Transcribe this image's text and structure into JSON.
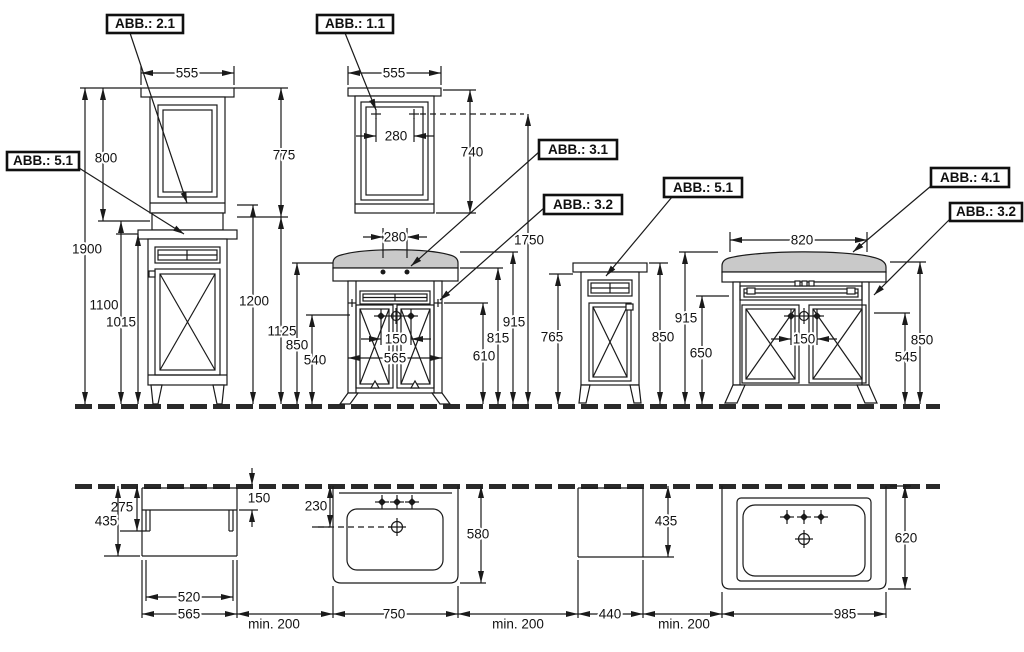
{
  "callouts": {
    "c21": "ABB.: 2.1",
    "c11": "ABB.: 1.1",
    "c51a": "ABB.: 5.1",
    "c31": "ABB.: 3.1",
    "c32a": "ABB.: 3.2",
    "c51b": "ABB.: 5.1",
    "c41": "ABB.: 4.1",
    "c32b": "ABB.: 3.2"
  },
  "dims": {
    "t555": "555",
    "t800": "800",
    "t1900": "1900",
    "t1100": "1100",
    "t1015": "1015",
    "t1200": "1200",
    "m555": "555",
    "m280": "280",
    "m740": "740",
    "m775": "775",
    "m1750": "1750",
    "v280": "280",
    "v150": "150",
    "v565": "565",
    "v540": "540",
    "v850": "850",
    "v1125": "1125",
    "v610": "610",
    "v815": "815",
    "v915": "915",
    "s765": "765",
    "s850": "850",
    "r915": "915",
    "r650": "650",
    "w820": "820",
    "w150": "150",
    "w545": "545",
    "w850": "850",
    "p435": "435",
    "p275": "275",
    "p150": "150",
    "p520": "520",
    "p565": "565",
    "q230": "230",
    "q580": "580",
    "q750": "750",
    "u435": "435",
    "u440": "440",
    "z620": "620",
    "z985": "985",
    "min200": "min.  200"
  }
}
